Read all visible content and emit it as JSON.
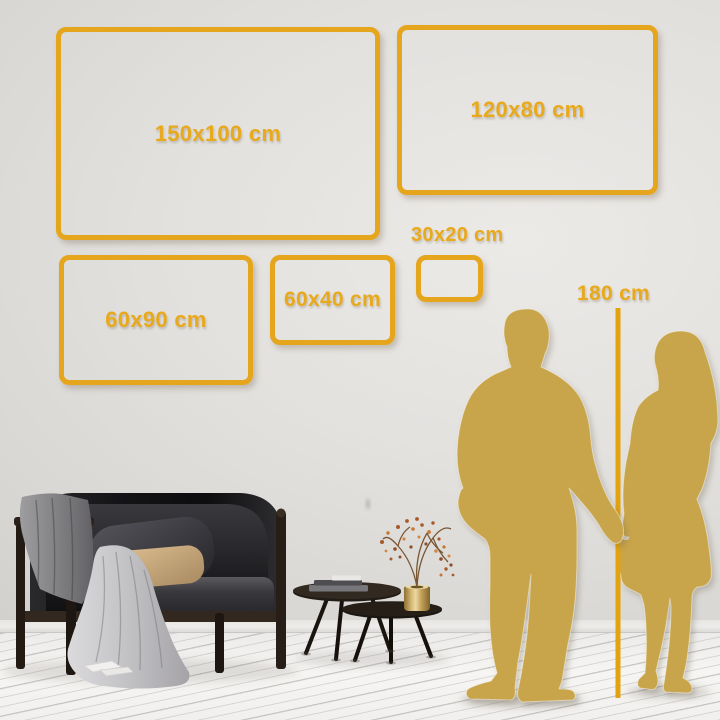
{
  "sizes": [
    {
      "label": "150x100 cm"
    },
    {
      "label": "120x80 cm"
    },
    {
      "label": "60x90 cm"
    },
    {
      "label": "60x40 cm"
    },
    {
      "label": "30x20 cm"
    }
  ],
  "height_reference": {
    "label": "180 cm"
  },
  "colors": {
    "frame_gold": "#E5A51C",
    "label_gold": "#E8A91C",
    "silhouette_gold": "#C8A54B",
    "marker_line_gold": "#E2A30E",
    "wall": "#DFDDDA",
    "floor": "#F4F3F1"
  },
  "scene": {
    "silhouettes": [
      "man-silhouette",
      "woman-silhouette"
    ],
    "furniture": [
      "sofa",
      "gray-blanket",
      "light-blanket",
      "dark-pillow",
      "tan-pillow",
      "coffee-table-large",
      "coffee-table-small",
      "books",
      "brass-vase",
      "dried-plant"
    ]
  }
}
